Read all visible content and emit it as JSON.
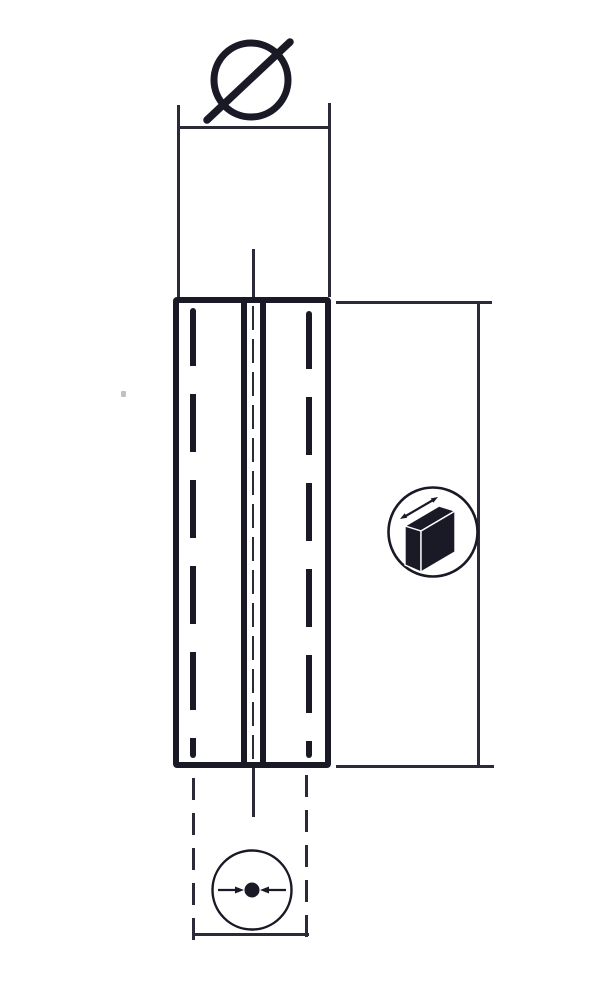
{
  "meta": {
    "description": "Black-and-white technical catalog drawing of a slotted spring pin, side view, with three dimension callouts",
    "background_color": "#ffffff",
    "ink_color": "#1a1926"
  },
  "drawing": {
    "view": "pin side view with hidden inner-diameter dashed lines and a central slot",
    "symbols": [
      {
        "name": "diameter-symbol",
        "glyph": "Ø",
        "position": "top",
        "label": "outer diameter dimension symbol"
      },
      {
        "name": "length-box-icon",
        "glyph": "3D block with double-headed arrow along its edge",
        "position": "right",
        "label": "length dimension icon"
      },
      {
        "name": "inner-diameter-dot-icon",
        "glyph": "center dot with two arrows pointing inward",
        "position": "bottom",
        "label": "inner diameter dimension icon"
      }
    ]
  }
}
